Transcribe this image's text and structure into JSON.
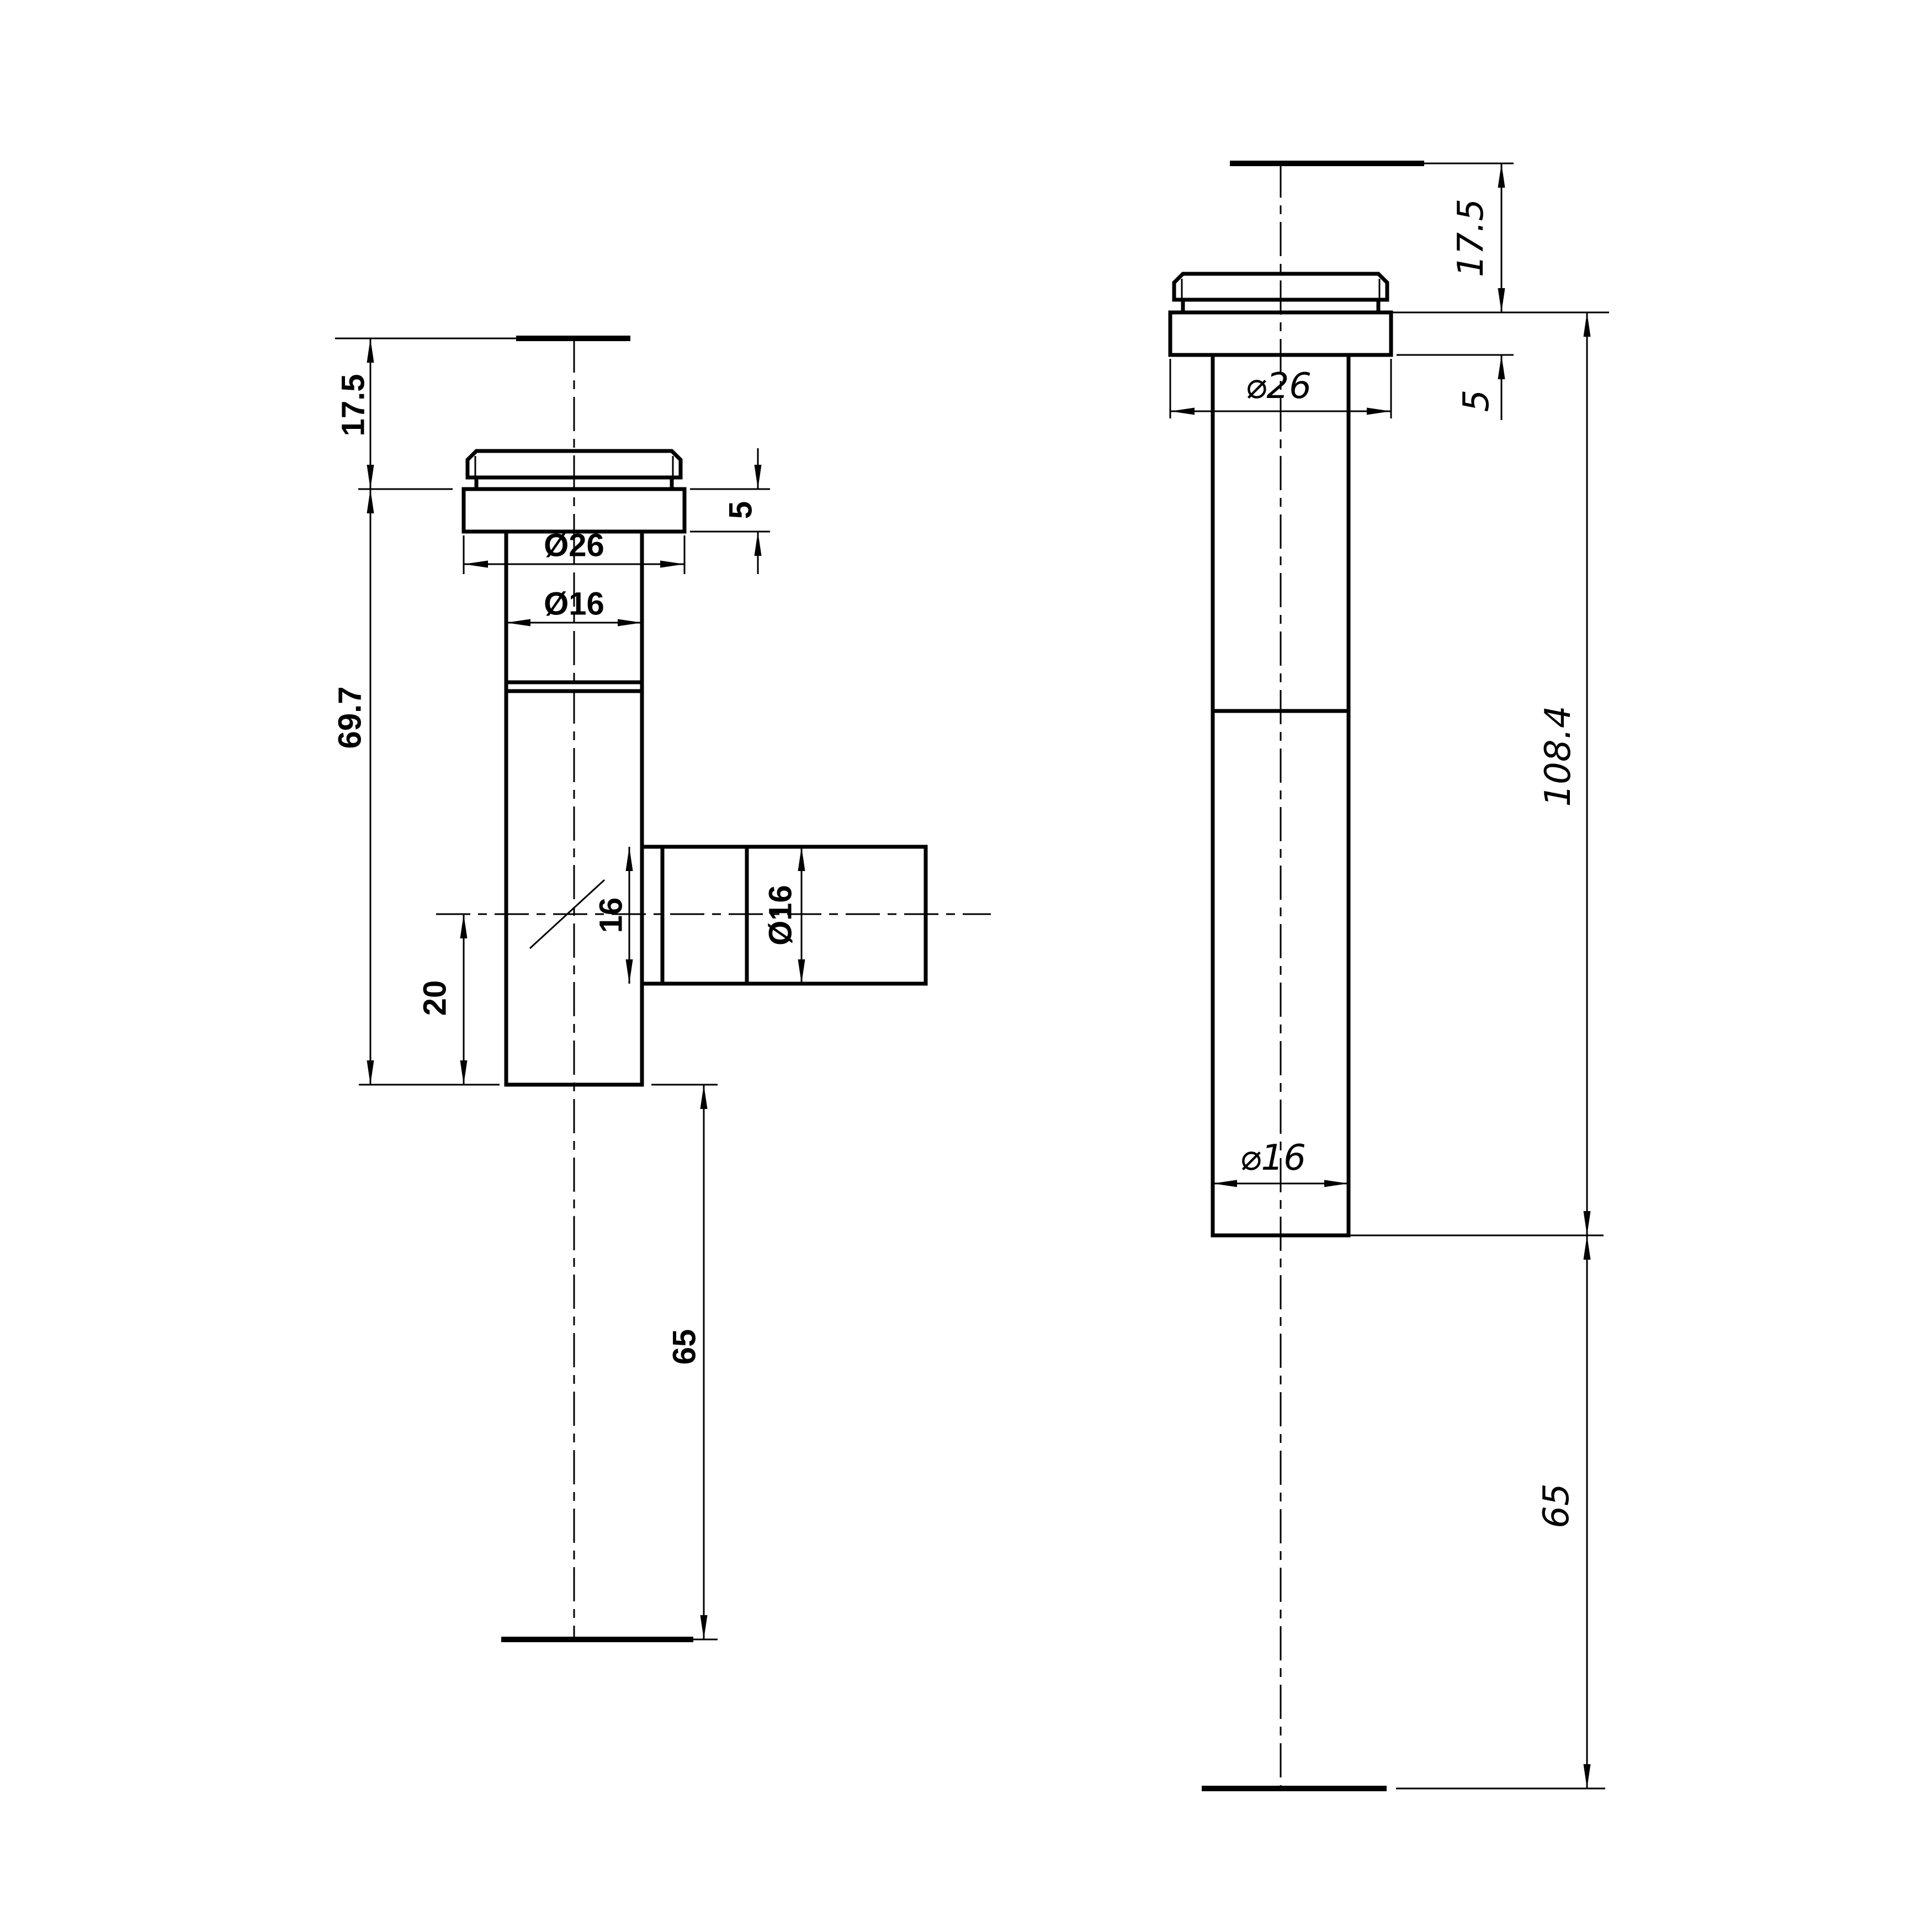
{
  "title": "tap-fitting-two-view-technical-drawing",
  "colors": {
    "background": "#ffffff",
    "line": "#000000"
  },
  "front_view": {
    "dim_cap_height": "17.5",
    "dim_body_length": "69.7",
    "dim_flange_diameter": "Ø26",
    "dim_body_diameter": "Ø16",
    "dim_flange_thickness": "5",
    "dim_branch_bore": "16",
    "dim_branch_diameter": "Ø16",
    "dim_branch_offset": "20",
    "dim_tail_length": "65"
  },
  "side_view": {
    "dim_cap_height": "17.5",
    "dim_flange_thickness": "5",
    "dim_flange_diameter": "⌀26",
    "dim_overall_length": "108.4",
    "dim_body_diameter": "⌀16",
    "dim_tail_length": "65"
  }
}
